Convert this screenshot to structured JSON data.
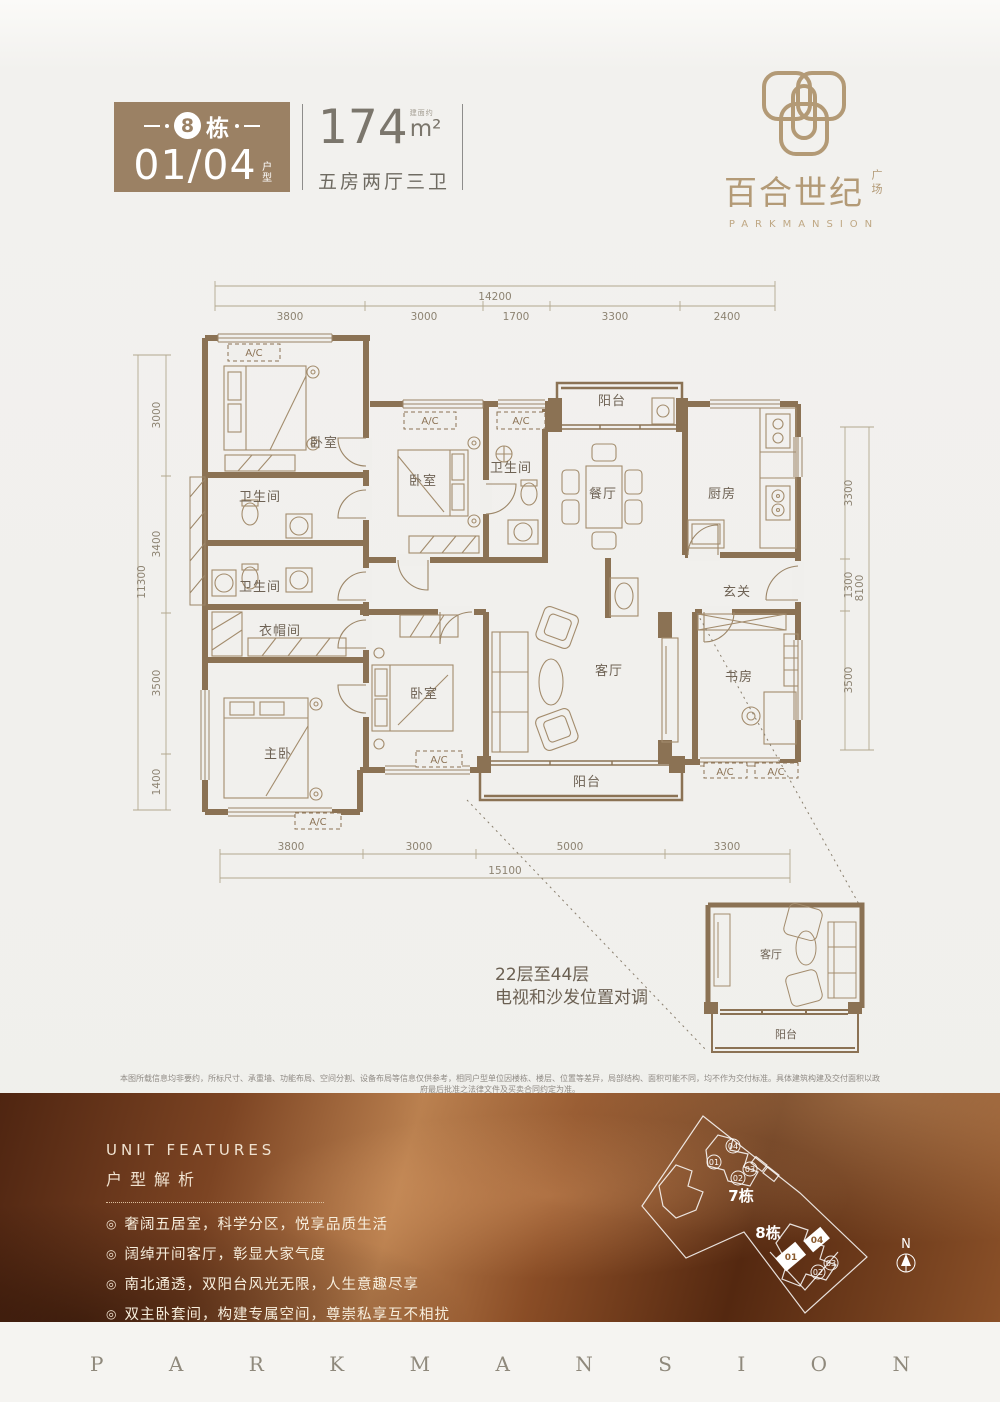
{
  "colors": {
    "badge_bg": "#9b8164",
    "logo_gold": "#b39a76",
    "wall_brown": "#8b7254",
    "page_bg": "#f0efec",
    "feature_copper": "#8a4d26",
    "feature_text": "#f3e7d6",
    "footer_bg": "#f5f4f1"
  },
  "header": {
    "badge": {
      "building_number": "8",
      "building_label": "栋",
      "unit_code": "01/04",
      "unit_type_label": "户型"
    },
    "area": {
      "note": "建面约",
      "value": "174",
      "unit": "m²",
      "layout": "五房两厅三卫"
    },
    "logo": {
      "name_cn": "百合世纪",
      "name_suffix": "广场",
      "name_en": "PARKMANSION"
    }
  },
  "floorplan": {
    "ac_label": "A/C",
    "rooms": [
      "卧室",
      "卫生间",
      "卫生间",
      "衣帽间",
      "主卧",
      "卧室",
      "卫生间",
      "阳台",
      "餐厅",
      "厨房",
      "玄关",
      "书房",
      "客厅",
      "卧室",
      "阳台"
    ],
    "dimensions": {
      "top": {
        "total": "14200",
        "segments": [
          "3800",
          "3000",
          "1700",
          "3300",
          "2400"
        ]
      },
      "bottom": {
        "total": "15100",
        "segments": [
          "3800",
          "3000",
          "5000",
          "3300"
        ]
      },
      "left": {
        "total": "11300",
        "segments": [
          "3000",
          "3400",
          "3500",
          "1400"
        ]
      },
      "right": {
        "total": "8100",
        "segments": [
          "3300",
          "1300",
          "3500"
        ]
      }
    },
    "inset": {
      "note_line1": "22层至44层",
      "note_line2": "电视和沙发位置对调",
      "living_label": "客厅",
      "balcony_label": "阳台"
    }
  },
  "disclaimer": "本图所载信息均非要约，所标尺寸、承重墙、功能布局、空间分割、设备布局等信息仅供参考，相同户型单位因楼栋、楼层、位置等差异，局部结构、面积可能不同，均不作为交付标准。具体建筑构建及交付面积以政府最后批准之法律文件及买卖合同约定为准。",
  "features": {
    "title_en": "UNIT FEATURES",
    "title_cn": "户型解析",
    "bullet": "◎",
    "items": [
      "奢阔五居室，科学分区，悦享品质生活",
      "阔绰开间客厅，彰显大家气度",
      "南北通透，双阳台风光无限，人生意趣尽享",
      "双主卧套间，构建专属空间，尊崇私享互不相扰"
    ]
  },
  "siteplan": {
    "building_7": "7栋",
    "building_8": "8栋",
    "units_7": [
      "01",
      "04",
      "02",
      "03"
    ],
    "units_8": [
      "01",
      "04",
      "02",
      "03"
    ],
    "north_label": "N"
  },
  "footer": {
    "brand": "PARKMANSION"
  }
}
